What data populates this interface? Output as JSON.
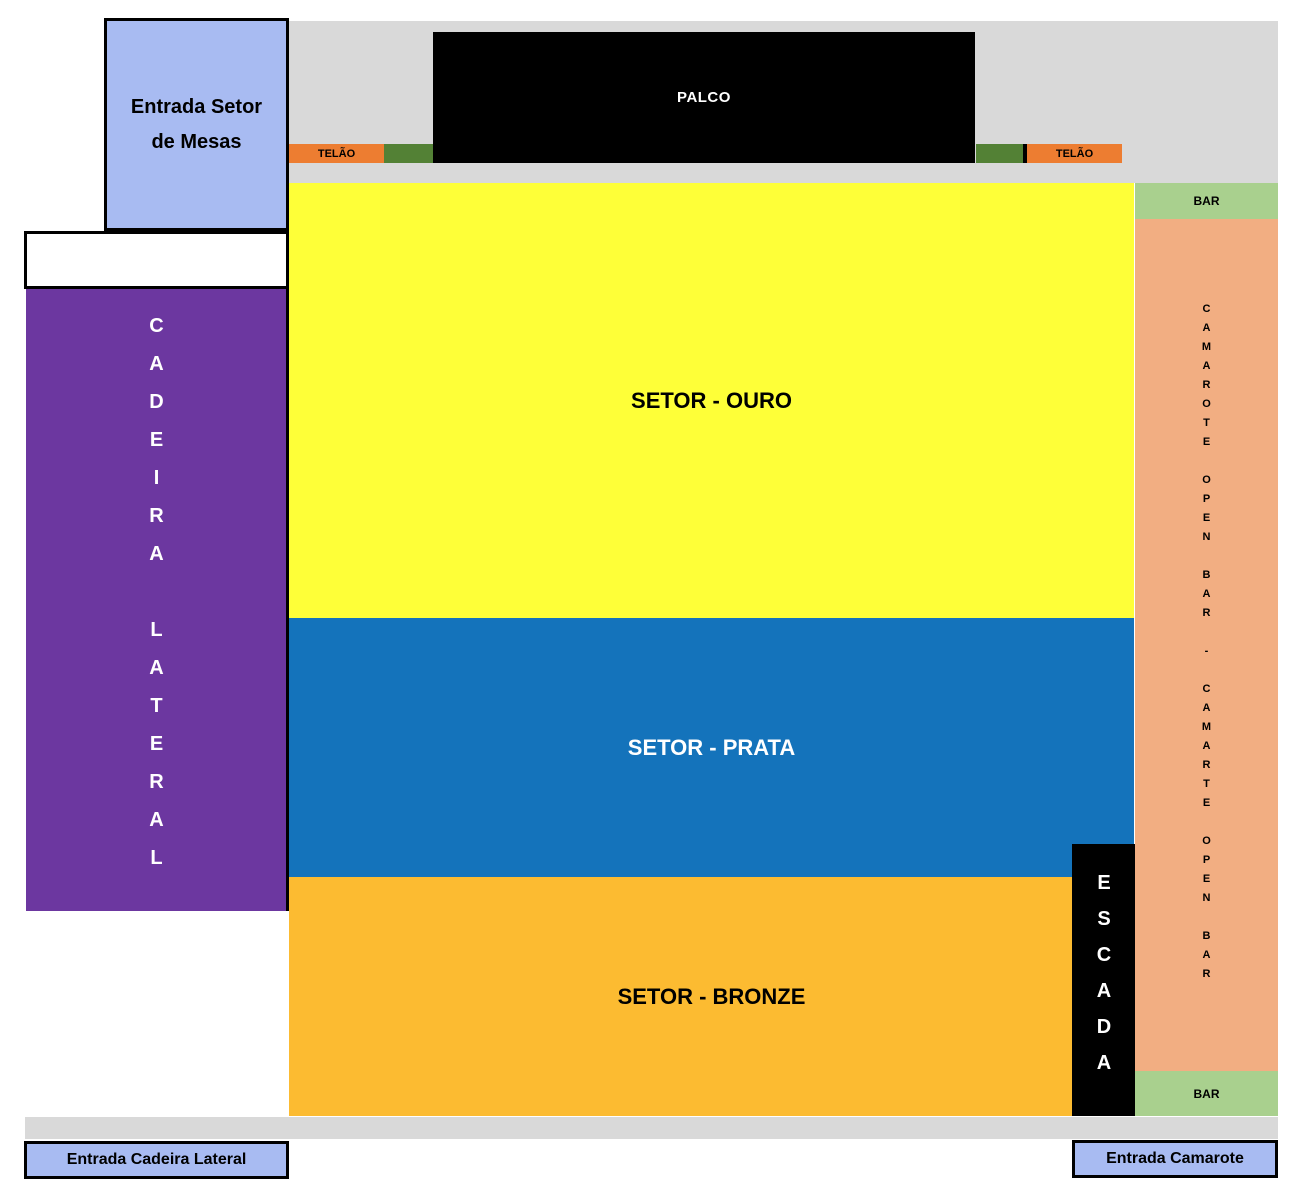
{
  "stage": {
    "label": "PALCO"
  },
  "screens": {
    "left_label": "TELÃO",
    "right_label": "TELÃO"
  },
  "sectors": {
    "ouro": {
      "label": "SETOR - OURO",
      "color": "#FEFF38"
    },
    "prata": {
      "label": "SETOR - PRATA",
      "color": "#1473BB"
    },
    "bronze": {
      "label": "SETOR - BRONZE",
      "color": "#FCBB31"
    },
    "cadeira_lateral": {
      "label": "CADEIRA LATERAL",
      "color": "#6C37A0"
    },
    "camarote": {
      "label": "CAMAROTE OPEN BAR - CAMARTE OPEN BAR",
      "color": "#F2AE82"
    }
  },
  "stairs": {
    "label": "ESCADA"
  },
  "bars": {
    "top_label": "BAR",
    "bottom_label": "BAR",
    "color": "#A9D08E"
  },
  "entrances": {
    "mesas": "Entrada Setor de Mesas",
    "cadeira_lateral": "Entrada Cadeira Lateral",
    "camarote": "Entrada Camarote"
  },
  "colors": {
    "floor_gray": "#D9D9D9",
    "screen_orange": "#ED7D31",
    "screen_green": "#538135",
    "entrance_blue": "#A8BBF2",
    "stage_black": "#000000"
  }
}
